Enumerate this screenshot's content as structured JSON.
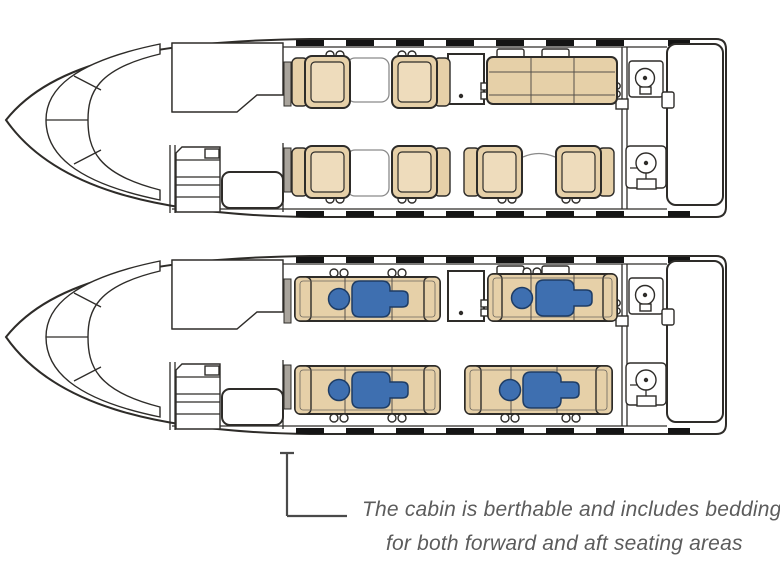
{
  "page": {
    "width": 780,
    "height": 574,
    "background": "#ffffff"
  },
  "colors": {
    "line": "#2e2c29",
    "seat_tan": "#e6d0a8",
    "seat_cushion": "#eedcbc",
    "passenger_blue": "#3e6fb0",
    "passenger_outline": "#1e3c64",
    "wall_gray": "#a9a49c",
    "window_black": "#151515",
    "table_outline": "#8a8a8a",
    "caption_text": "#5c5c5c",
    "leader_line": "#4a4a4a"
  },
  "caption": {
    "line1": "The cabin is berthable and includes bedding",
    "line2": "for both forward and aft seating areas"
  },
  "diagrams": {
    "top": {
      "name": "day-seating-configuration",
      "single_seats": 6,
      "divan_seats": 3,
      "features": [
        "cockpit-windscreen",
        "forward-closet",
        "entry-airstair",
        "credenza",
        "mid-cabinet",
        "aft-lavatory-sink",
        "aft-lavatory-toilet",
        "aft-baggage-compartment",
        "cabin-windows"
      ]
    },
    "bottom": {
      "name": "berthed-sleeping-configuration",
      "berths": 4,
      "passengers_shown": 4
    }
  }
}
